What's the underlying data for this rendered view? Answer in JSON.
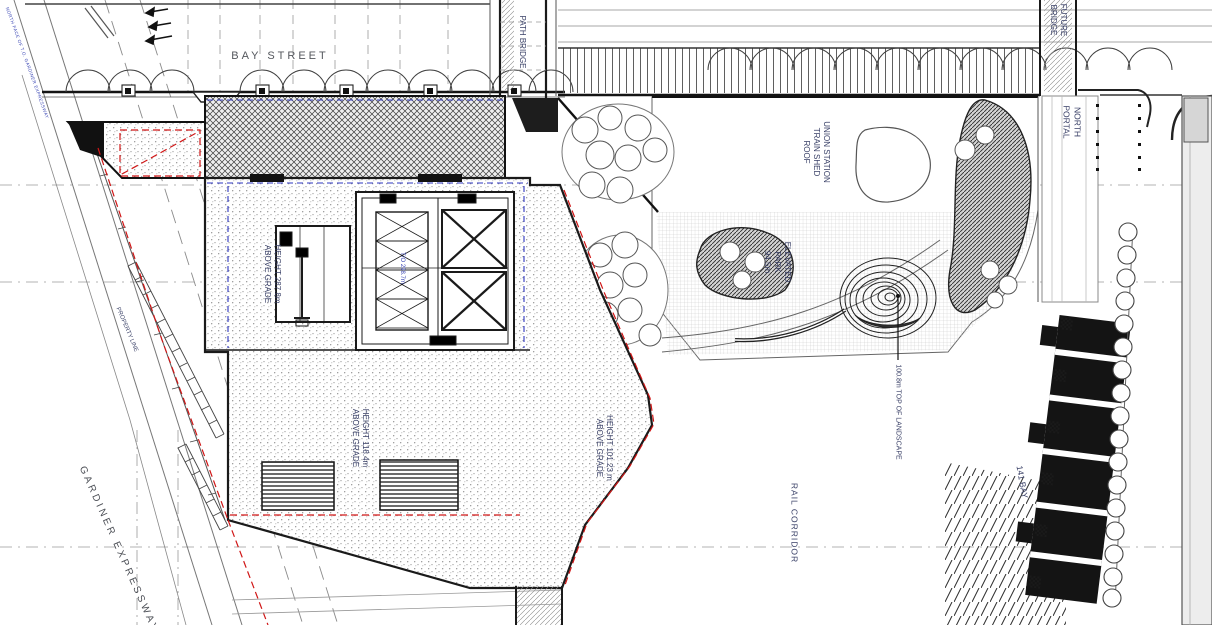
{
  "plan": {
    "streets": {
      "bay_street": "BAY STREET",
      "gardiner_expressway": "GARDINER EXPRESSWAY",
      "rail_corridor": "RAIL CORRIDOR"
    },
    "structures": {
      "path_bridge": "PATH BRIDGE",
      "future_bridge": "FUTURE\nBRIDGE",
      "north_portal": "NORTH\nPORTAL",
      "union_station_roof": "UNION STATION\nTRAIN SHED\nROOF",
      "elevated_park": "ELEVATED\nPARK\n94.5m",
      "bay_141": "141 BAY"
    },
    "annotations": {
      "north_face": "NORTH FACE OF T.O. GARDINER EXPRESSWAY",
      "property_line": "PROPERTY LINE",
      "height_tower": "HEIGHT 287.8m\nABOVE GRADE",
      "core_elevation": "T/O 298.7m",
      "height_podium": "HEIGHT 118.4m\nABOVE GRADE",
      "height_east_podium": "HEIGHT  101.23 m\nABOVE GRADE",
      "top_of_landscape": "100.8m TOP OF LANDSCAPE"
    },
    "colors": {
      "property_line_red": "#d01616",
      "guide_blue": "#2d36c0",
      "label_ink": "#383f66",
      "street_gray": "#54575d"
    }
  }
}
